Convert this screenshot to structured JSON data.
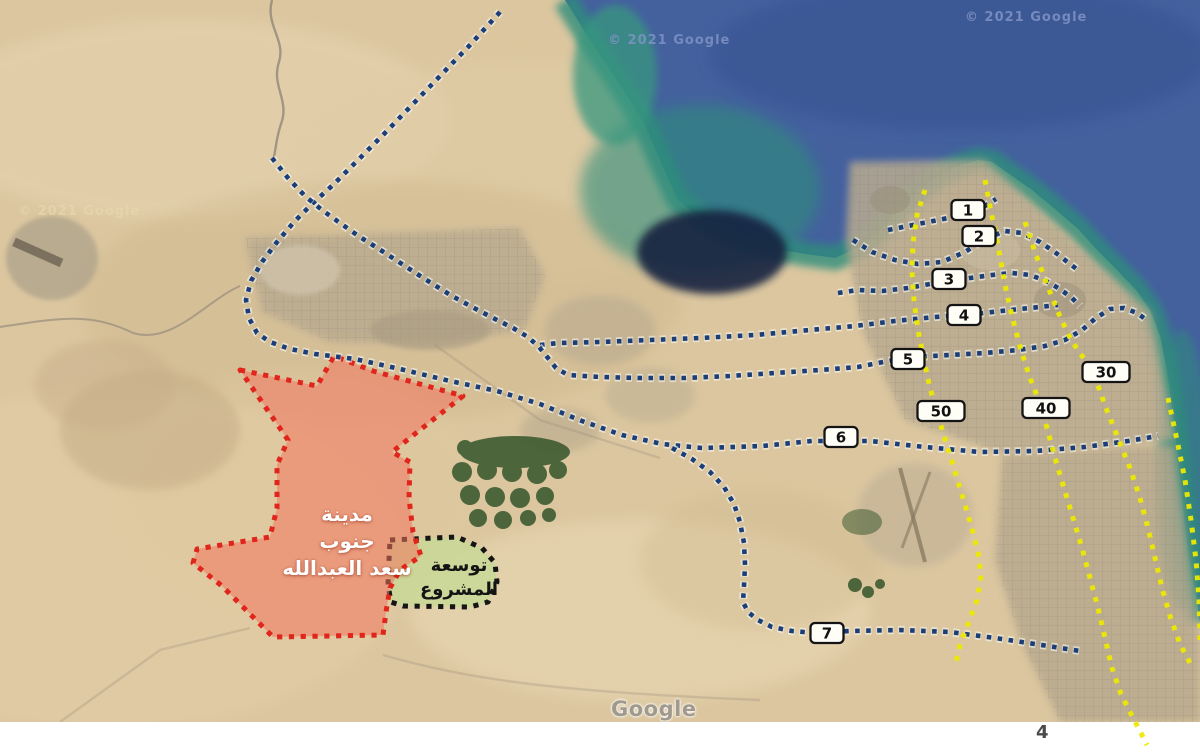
{
  "page": {
    "number": "4"
  },
  "watermarks": [
    {
      "text": "© 2021 Google",
      "style": "sea",
      "x": 608,
      "y": 33
    },
    {
      "text": "© 2021 Google",
      "style": "sea",
      "x": 965,
      "y": 10
    },
    {
      "text": "© 2021 Google",
      "style": "sand",
      "x": 18,
      "y": 204
    }
  ],
  "google_logo": {
    "text": "Google"
  },
  "map": {
    "colors": {
      "route_blue": "#1c3e78",
      "route_halo": "#f6f6ef",
      "route_yellow": "#ece900",
      "area_red_border": "#e0261c",
      "area_red_fill": "rgba(242,116,95,0.55)",
      "area_green_border": "#151515",
      "area_green_fill": "rgba(200,216,150,0.85)",
      "label_box_fill": "#fffef6",
      "label_box_border": "#141414",
      "sea_deep": "#44619e",
      "sea_shallow": "#2f8d7b",
      "desert": "#dbc69f"
    },
    "areas": [
      {
        "id": "project-expansion-area",
        "label_lines": [
          "توسعة",
          "المشروع"
        ],
        "fill": "rgba(200,216,150,0.85)",
        "border": "#151515",
        "points": [
          [
            390,
            540
          ],
          [
            457,
            537
          ],
          [
            482,
            548
          ],
          [
            495,
            563
          ],
          [
            497,
            582
          ],
          [
            488,
            602
          ],
          [
            470,
            607
          ],
          [
            403,
            606
          ],
          [
            391,
            602
          ],
          [
            388,
            585
          ],
          [
            389,
            560
          ]
        ]
      },
      {
        "id": "south-saad-alabdullah-city-area",
        "label_lines": [
          "مدينة",
          "جنوب",
          "سعد العبدالله"
        ],
        "fill": "rgba(242,116,95,0.55)",
        "border": "#e0261c",
        "points": [
          [
            240,
            370
          ],
          [
            317,
            386
          ],
          [
            334,
            356
          ],
          [
            373,
            371
          ],
          [
            463,
            396
          ],
          [
            392,
            452
          ],
          [
            410,
            462
          ],
          [
            409,
            498
          ],
          [
            413,
            532
          ],
          [
            421,
            556
          ],
          [
            400,
            570
          ],
          [
            390,
            588
          ],
          [
            386,
            612
          ],
          [
            383,
            635
          ],
          [
            273,
            637
          ],
          [
            222,
            586
          ],
          [
            193,
            563
          ],
          [
            197,
            549
          ],
          [
            270,
            537
          ],
          [
            277,
            508
          ],
          [
            277,
            465
          ],
          [
            288,
            440
          ]
        ]
      }
    ],
    "routes": [
      {
        "id": "route-north-and-6",
        "color": "blue",
        "points": [
          [
            500,
            12
          ],
          [
            470,
            45
          ],
          [
            440,
            76
          ],
          [
            412,
            105
          ],
          [
            384,
            134
          ],
          [
            357,
            161
          ],
          [
            333,
            185
          ],
          [
            313,
            203
          ],
          [
            294,
            222
          ],
          [
            277,
            242
          ],
          [
            262,
            262
          ],
          [
            251,
            281
          ],
          [
            246,
            300
          ],
          [
            249,
            318
          ],
          [
            257,
            333
          ],
          [
            270,
            342
          ],
          [
            290,
            349
          ],
          [
            315,
            354
          ],
          [
            355,
            359
          ],
          [
            400,
            369
          ],
          [
            450,
            381
          ],
          [
            497,
            391
          ],
          [
            540,
            404
          ],
          [
            582,
            421
          ],
          [
            622,
            435
          ],
          [
            662,
            444
          ],
          [
            702,
            448
          ],
          [
            762,
            446
          ],
          [
            812,
            441
          ],
          [
            870,
            441
          ],
          [
            925,
            447
          ],
          [
            980,
            452
          ],
          [
            1035,
            451
          ],
          [
            1085,
            447
          ],
          [
            1128,
            441
          ],
          [
            1158,
            436
          ]
        ]
      },
      {
        "id": "route-4",
        "color": "blue",
        "points": [
          [
            540,
            345
          ],
          [
            558,
            343
          ],
          [
            600,
            342
          ],
          [
            650,
            340
          ],
          [
            700,
            338
          ],
          [
            755,
            335
          ],
          [
            810,
            330
          ],
          [
            855,
            326
          ],
          [
            895,
            321
          ],
          [
            935,
            317
          ],
          [
            975,
            314
          ],
          [
            1010,
            310
          ],
          [
            1040,
            307
          ],
          [
            1058,
            305
          ]
        ]
      },
      {
        "id": "route-5",
        "color": "blue",
        "points": [
          [
            272,
            158
          ],
          [
            288,
            178
          ],
          [
            305,
            196
          ],
          [
            322,
            210
          ],
          [
            340,
            223
          ],
          [
            360,
            237
          ],
          [
            382,
            251
          ],
          [
            405,
            266
          ],
          [
            428,
            281
          ],
          [
            452,
            296
          ],
          [
            474,
            308
          ],
          [
            495,
            319
          ],
          [
            513,
            328
          ],
          [
            528,
            337
          ],
          [
            539,
            347
          ],
          [
            548,
            358
          ],
          [
            556,
            368
          ],
          [
            568,
            375
          ],
          [
            600,
            377
          ],
          [
            640,
            378
          ],
          [
            685,
            378
          ],
          [
            730,
            376
          ],
          [
            775,
            373
          ],
          [
            820,
            370
          ],
          [
            858,
            367
          ],
          [
            888,
            361
          ],
          [
            915,
            357
          ],
          [
            950,
            355
          ],
          [
            985,
            353
          ],
          [
            1018,
            350
          ],
          [
            1045,
            346
          ],
          [
            1065,
            340
          ],
          [
            1082,
            330
          ],
          [
            1096,
            318
          ],
          [
            1110,
            309
          ],
          [
            1124,
            308
          ],
          [
            1137,
            313
          ],
          [
            1148,
            321
          ]
        ]
      },
      {
        "id": "route-7",
        "color": "blue",
        "points": [
          [
            672,
            448
          ],
          [
            692,
            459
          ],
          [
            710,
            472
          ],
          [
            724,
            487
          ],
          [
            734,
            504
          ],
          [
            740,
            522
          ],
          [
            744,
            543
          ],
          [
            745,
            565
          ],
          [
            744,
            586
          ],
          [
            743,
            602
          ],
          [
            748,
            612
          ],
          [
            758,
            620
          ],
          [
            772,
            627
          ],
          [
            792,
            631
          ],
          [
            815,
            633
          ],
          [
            850,
            631
          ],
          [
            900,
            630
          ],
          [
            950,
            632
          ],
          [
            995,
            638
          ],
          [
            1035,
            644
          ],
          [
            1080,
            651
          ]
        ]
      },
      {
        "id": "ring-1",
        "color": "blue",
        "points": [
          [
            888,
            230
          ],
          [
            908,
            226
          ],
          [
            928,
            222
          ],
          [
            948,
            218
          ],
          [
            968,
            212
          ],
          [
            985,
            206
          ],
          [
            996,
            199
          ]
        ]
      },
      {
        "id": "ring-2",
        "color": "blue",
        "points": [
          [
            853,
            240
          ],
          [
            872,
            252
          ],
          [
            895,
            260
          ],
          [
            918,
            264
          ],
          [
            942,
            262
          ],
          [
            965,
            252
          ],
          [
            985,
            239
          ],
          [
            1005,
            231
          ],
          [
            1022,
            233
          ],
          [
            1040,
            242
          ],
          [
            1056,
            253
          ],
          [
            1070,
            264
          ],
          [
            1078,
            270
          ]
        ]
      },
      {
        "id": "ring-3",
        "color": "blue",
        "points": [
          [
            838,
            293
          ],
          [
            858,
            290
          ],
          [
            882,
            291
          ],
          [
            908,
            288
          ],
          [
            930,
            284
          ],
          [
            950,
            281
          ],
          [
            970,
            278
          ],
          [
            992,
            275
          ],
          [
            1012,
            273
          ],
          [
            1030,
            275
          ],
          [
            1046,
            281
          ],
          [
            1060,
            289
          ],
          [
            1072,
            298
          ],
          [
            1080,
            306
          ]
        ]
      },
      {
        "id": "highway-50",
        "color": "yellow",
        "points": [
          [
            925,
            190
          ],
          [
            917,
            215
          ],
          [
            913,
            243
          ],
          [
            912,
            272
          ],
          [
            914,
            300
          ],
          [
            918,
            330
          ],
          [
            924,
            360
          ],
          [
            930,
            388
          ],
          [
            937,
            412
          ],
          [
            944,
            436
          ],
          [
            953,
            465
          ],
          [
            962,
            495
          ],
          [
            971,
            525
          ],
          [
            978,
            552
          ],
          [
            981,
            576
          ],
          [
            977,
            600
          ],
          [
            968,
            624
          ],
          [
            960,
            645
          ],
          [
            956,
            662
          ]
        ]
      },
      {
        "id": "highway-40",
        "color": "yellow",
        "points": [
          [
            985,
            180
          ],
          [
            990,
            207
          ],
          [
            996,
            235
          ],
          [
            1001,
            262
          ],
          [
            1006,
            290
          ],
          [
            1013,
            320
          ],
          [
            1021,
            350
          ],
          [
            1030,
            378
          ],
          [
            1040,
            403
          ],
          [
            1047,
            428
          ],
          [
            1055,
            458
          ],
          [
            1064,
            488
          ],
          [
            1073,
            518
          ],
          [
            1082,
            548
          ],
          [
            1090,
            578
          ],
          [
            1098,
            608
          ],
          [
            1105,
            638
          ],
          [
            1112,
            668
          ],
          [
            1121,
            694
          ],
          [
            1131,
            714
          ],
          [
            1141,
            733
          ],
          [
            1147,
            745
          ]
        ]
      },
      {
        "id": "highway-30",
        "color": "yellow",
        "points": [
          [
            1025,
            222
          ],
          [
            1035,
            252
          ],
          [
            1046,
            282
          ],
          [
            1058,
            312
          ],
          [
            1071,
            340
          ],
          [
            1085,
            360
          ],
          [
            1096,
            380
          ],
          [
            1106,
            408
          ],
          [
            1118,
            438
          ],
          [
            1130,
            468
          ],
          [
            1140,
            498
          ],
          [
            1148,
            528
          ],
          [
            1155,
            558
          ],
          [
            1162,
            588
          ],
          [
            1170,
            616
          ],
          [
            1180,
            644
          ],
          [
            1190,
            663
          ]
        ]
      },
      {
        "id": "highway-coastal",
        "color": "yellow",
        "points": [
          [
            1168,
            398
          ],
          [
            1177,
            440
          ],
          [
            1185,
            480
          ],
          [
            1191,
            520
          ],
          [
            1196,
            560
          ],
          [
            1199,
            600
          ],
          [
            1200,
            640
          ]
        ]
      }
    ],
    "route_labels": [
      {
        "text": "1",
        "x": 968,
        "y": 210,
        "w": 33
      },
      {
        "text": "2",
        "x": 979,
        "y": 236,
        "w": 33
      },
      {
        "text": "3",
        "x": 949,
        "y": 279,
        "w": 33
      },
      {
        "text": "4",
        "x": 964,
        "y": 315,
        "w": 33
      },
      {
        "text": "5",
        "x": 908,
        "y": 359,
        "w": 33
      },
      {
        "text": "6",
        "x": 841,
        "y": 437,
        "w": 33
      },
      {
        "text": "7",
        "x": 827,
        "y": 633,
        "w": 33
      },
      {
        "text": "30",
        "x": 1106,
        "y": 372,
        "w": 47
      },
      {
        "text": "40",
        "x": 1046,
        "y": 408,
        "w": 47
      },
      {
        "text": "50",
        "x": 941,
        "y": 411,
        "w": 47
      }
    ]
  }
}
